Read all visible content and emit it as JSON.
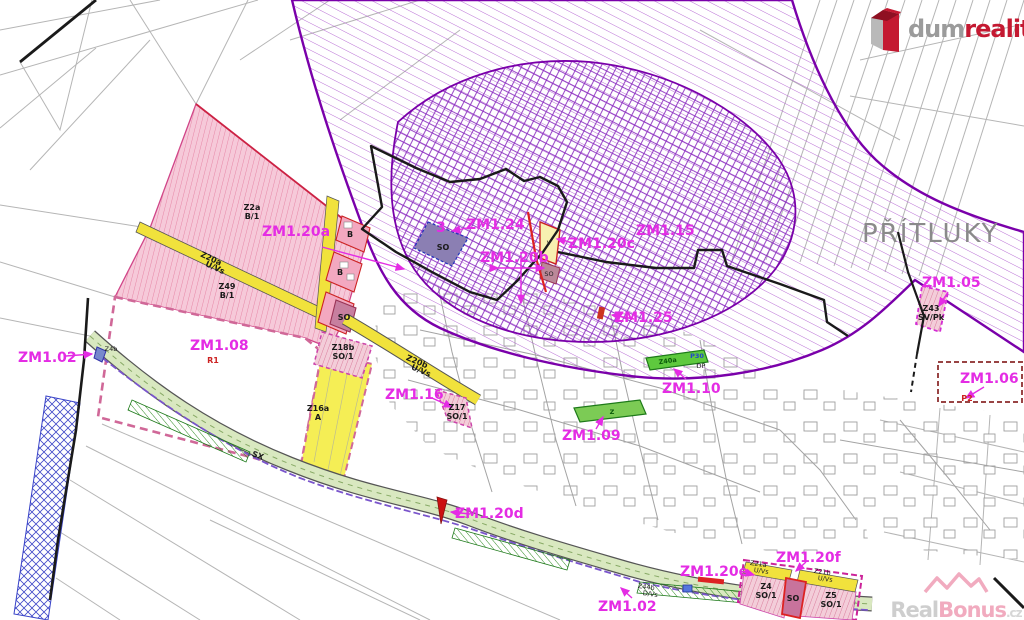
{
  "branding": {
    "logo": {
      "prefix": "dum",
      "highlight": "realit",
      "suffix": ".cz"
    },
    "watermark": {
      "prefix": "Real",
      "highlight": "Bonus",
      "suffix": ".cz"
    }
  },
  "map": {
    "place_name": "PŘÍTLUKY",
    "change_labels": {
      "zm102_left": "ZM1.02",
      "zm102_bottom": "ZM1.02",
      "zm105": "ZM1.05",
      "zm106": "ZM1.06",
      "zm108": "ZM1.08",
      "zm109": "ZM1.09",
      "zm110": "ZM1.10",
      "zm115": "ZM1.15",
      "zm116": "ZM1.16",
      "zm120a": "ZM1.20a",
      "zm120b": "ZM1.20b",
      "zm120c": "ZM1.20c",
      "zm120d": "ZM1.20d",
      "zm120e": "ZM1.20e",
      "zm120f": "ZM1.20f",
      "zm124": "ZM1.24",
      "zm125": "ZM1.25"
    },
    "parcel_labels": {
      "z2a": "Z2a",
      "z2a_use": "B/1",
      "z49": "Z49",
      "z49_use": "B/1",
      "z20a": "Z20a",
      "z20a_use": "U/Vs",
      "z20b": "Z20b",
      "z20b_use": "U/Vs",
      "z18b": "Z18b",
      "z18b_use": "SO/1",
      "z16a": "Z16a",
      "z16a_use": "A",
      "z17": "Z17",
      "z17_use": "SO/1",
      "z43": "Z43",
      "z43_use": "SV/Pk",
      "z21a": "Z21a",
      "z21a_use": "U/Vs",
      "z21b": "Z21b",
      "z21b_use": "U/Vs",
      "z4": "Z4",
      "z4_use": "SO/1",
      "z5": "Z5",
      "z5_use": "SO/1",
      "z40a": "Z40a",
      "p30": "P30",
      "dp": "DP",
      "z44b": "Z44b",
      "z44b_use": "D/Vs",
      "z4b": "Z4b",
      "r1": "R1",
      "p2": "P2",
      "b": "B",
      "so": "SO",
      "v": "V",
      "z": "Z",
      "sx": "SX",
      "n3": "3"
    },
    "colors": {
      "label_magenta": "#e42ce4",
      "hatch_purple": "#a355cc",
      "boundary_purple": "#7a00aa",
      "pink_zone": "#f6c9d9",
      "pink_block": "#f3a8c0",
      "yellow_zone": "#f1e23c",
      "green_corridor": "#d9e8c0",
      "green_parcel": "#5ec93e",
      "blue_hatch": "#3a44c8",
      "red_marker": "#dd2222",
      "maroon_dash": "#994444",
      "logo_red": "#c41931",
      "watermark_pink": "#ef9db4",
      "place_gray": "#8a8a8a"
    }
  }
}
